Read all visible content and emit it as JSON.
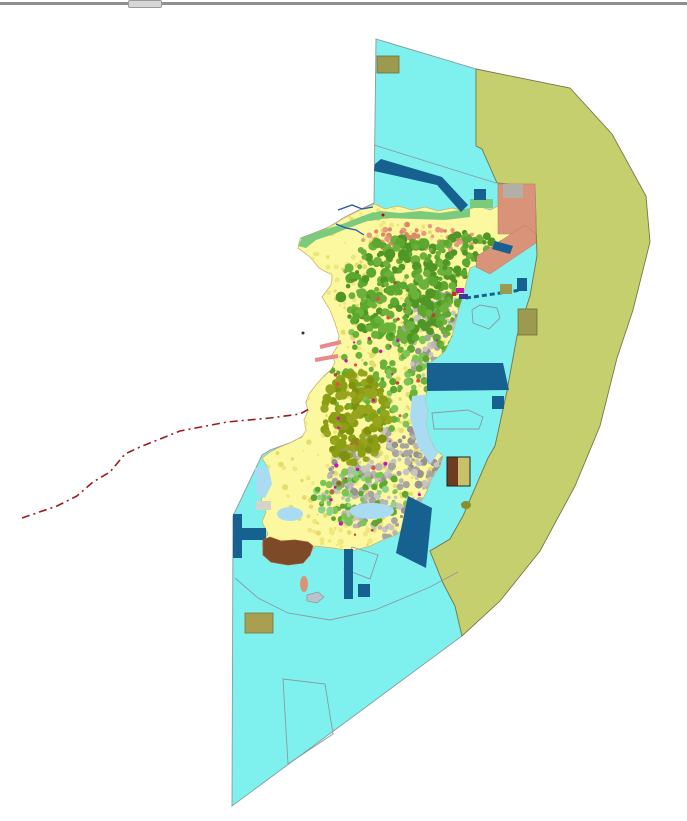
{
  "window": {
    "edge_style": "background:#8f8f8f",
    "handle_style": "background:#d6d6d6;border:1px solid #9a9a9a"
  },
  "map": {
    "width": 687,
    "height": 815,
    "background": "#ffffff",
    "palette": {
      "water": "#7EF1EF",
      "planning_zone": "#C6CF6E",
      "island_base": "#FCF8A0",
      "forest_green": "#5CA82E",
      "olive_parcels": "#8C9E14",
      "urban_gray": "#A8A5A0",
      "reclamation_salmon": "#D99379",
      "harbor_blue": "#16618F",
      "khaki_parcel": "#9C9A4E",
      "boundary_red": "#9E1A1A",
      "coast_green": "#7CCB7C",
      "lagoon_blue": "#A9DCF2",
      "brown_fill": "#7C4A26"
    },
    "island_outline": "375,198 385,203 398,200 412,204 425,201 438,205 452,202 465,205 478,200 490,204 498,200 498,178 535,178 536,228 527,240 510,252 495,260 480,258 470,262 466,278 463,290 459,302 456,315 452,330 445,345 437,352 429,357 427,362 427,385 425,395 428,405 426,418 429,430 435,443 443,450 440,460 432,472 426,487 419,500 412,510 405,520 398,528 385,533 370,540 352,545 333,542 315,540 303,557 280,556 266,551 262,538 268,528 262,516 266,506 261,493 269,482 262,472 268,462 262,452 270,446 280,441 292,436 302,431 306,424 304,414 308,405 306,397 309,388 316,379 323,371 331,364 335,356 332,349 337,341 339,330 335,317 330,304 322,291 331,279 332,269 319,262 310,251 298,242 300,233 313,228 328,222 344,212 360,204",
    "shapes": [
      {
        "name": "water-area",
        "type": "polygon",
        "pts": "376,33 476,63 476,140 482,143 497,177 535,180 537,250 530,290 517,330 507,385 495,440 488,452 463,510 450,533 430,545 443,577 455,600 462,630 232,800 233,510 262,449 270,444 292,436 303,430 307,423 305,414 309,404 306,396 310,387 317,378 324,370 332,363 336,355 333,348 338,340 340,329 336,316 331,303 323,290 332,278 333,268 320,261 311,250 299,241 301,232 314,227 329,221 345,211 361,203 374,197",
        "fill": "#7EF1EF",
        "stroke": "#8A9AA0",
        "sw": 0.9
      },
      {
        "name": "planning-zone",
        "type": "polygon",
        "pts": "476,63 570,82 612,128 646,190 650,236 633,304 617,352 600,420 575,480 540,545 500,595 462,630 455,600 443,577 430,545 450,533 463,510 488,452 495,440 507,385 517,330 530,290 537,250 535,180 497,177 482,143 476,140",
        "fill": "#C6CF6E",
        "stroke": "#77774D",
        "sw": 0.9
      },
      {
        "name": "water-division-line-north",
        "type": "polyline",
        "pts": "374,139 496,177",
        "stroke": "#8A9AA0",
        "sw": 0.9
      },
      {
        "name": "water-division-line-south",
        "type": "polyline",
        "pts": "235,572 258,592 288,607 330,614 375,604 430,581 458,566",
        "stroke": "#8A9AA0",
        "sw": 0.9
      },
      {
        "name": "survey-parcel-outline",
        "type": "polygon",
        "pts": "283,673 325,678 333,728 288,758",
        "fill": "none",
        "stroke": "#8A9AA0",
        "sw": 0.9
      },
      {
        "name": "khaki-parcel-north",
        "type": "rect",
        "x": 377,
        "y": 50,
        "w": 22,
        "h": 17,
        "fill": "#9C9A4E",
        "stroke": "#6F6E35",
        "sw": 0.8
      },
      {
        "name": "island-landmass",
        "type": "polygon",
        "use_outline": true,
        "fill": "#FCF8A0",
        "stroke": "#C9B568",
        "sw": 0.8
      },
      {
        "name": "parcel-texture",
        "type": "speckles",
        "seed": 1,
        "cx": 380,
        "cy": 380,
        "rx": 125,
        "ry": 180,
        "count": 550,
        "rmin": 1,
        "rmax": 3,
        "colors": [
          "#EFE77E",
          "#E6DC6C"
        ],
        "clip": true
      },
      {
        "name": "road-texture-north",
        "type": "speckles",
        "seed": 2,
        "cx": 420,
        "cy": 232,
        "rx": 58,
        "ry": 14,
        "count": 70,
        "rmin": 1.5,
        "rmax": 3,
        "colors": [
          "#E59980",
          "#D98868"
        ],
        "clip": true
      },
      {
        "name": "urban-south",
        "type": "speckles",
        "seed": 3,
        "cx": 402,
        "cy": 478,
        "rx": 80,
        "ry": 55,
        "count": 430,
        "rmin": 1.5,
        "rmax": 4,
        "colors": [
          "#A8A5A0",
          "#B9B6B1",
          "#C8C5C0",
          "#979490"
        ],
        "clip": true
      },
      {
        "name": "urban-east",
        "type": "speckles",
        "seed": 4,
        "cx": 443,
        "cy": 330,
        "rx": 40,
        "ry": 46,
        "count": 190,
        "rmin": 1.5,
        "rmax": 4,
        "colors": [
          "#A8A5A0",
          "#B9B6B1",
          "#C8C5C0",
          "#979490"
        ],
        "clip": true
      },
      {
        "name": "green-mid",
        "type": "speckles",
        "seed": 5,
        "cx": 393,
        "cy": 368,
        "rx": 68,
        "ry": 55,
        "count": 130,
        "rmin": 2,
        "rmax": 4,
        "colors": [
          "#5CA82E",
          "#6BB13A",
          "#7CC455"
        ],
        "clip": true
      },
      {
        "name": "green-hills-north",
        "type": "speckles",
        "seed": 6,
        "cx": 398,
        "cy": 283,
        "rx": 58,
        "ry": 52,
        "count": 260,
        "rmin": 2,
        "rmax": 5.5,
        "colors": [
          "#5CA82E",
          "#6BB13A",
          "#4F9626"
        ],
        "clip": true
      },
      {
        "name": "green-hills-ne",
        "type": "speckles",
        "seed": 7,
        "cx": 472,
        "cy": 252,
        "rx": 36,
        "ry": 26,
        "count": 90,
        "rmin": 2,
        "rmax": 4.5,
        "colors": [
          "#5CA82E",
          "#6BB13A",
          "#4F9626"
        ],
        "clip": true
      },
      {
        "name": "green-hills-east",
        "type": "speckles",
        "seed": 8,
        "cx": 455,
        "cy": 322,
        "rx": 24,
        "ry": 30,
        "count": 60,
        "rmin": 2,
        "rmax": 4.5,
        "colors": [
          "#5CA82E",
          "#6BB13A"
        ],
        "clip": true
      },
      {
        "name": "olive-hill-central",
        "type": "speckles",
        "seed": 9,
        "cx": 356,
        "cy": 412,
        "rx": 33,
        "ry": 47,
        "count": 150,
        "rmin": 2.5,
        "rmax": 5,
        "colors": [
          "#8C9E14",
          "#7F9210",
          "#96A51C"
        ],
        "clip": true
      },
      {
        "name": "green-south",
        "type": "speckles",
        "seed": 10,
        "cx": 360,
        "cy": 492,
        "rx": 48,
        "ry": 28,
        "count": 85,
        "rmin": 2,
        "rmax": 4,
        "colors": [
          "#7CC455",
          "#8FD287",
          "#5CA82E"
        ],
        "clip": true
      },
      {
        "name": "red-roof-bits",
        "type": "speckles",
        "seed": 11,
        "cx": 400,
        "cy": 420,
        "rx": 85,
        "ry": 145,
        "count": 50,
        "rmin": 1,
        "rmax": 2.2,
        "colors": [
          "#C04040",
          "#C812B4",
          "#E05050"
        ],
        "clip": true
      },
      {
        "name": "lagoon-east",
        "type": "polygon",
        "pts": "412,390 430,388 434,415 440,445 430,458 418,440 410,412",
        "fill": "#A9DCF2",
        "clip": true
      },
      {
        "name": "lagoon-south-1",
        "type": "ellipse",
        "cx": 372,
        "cy": 505,
        "rx": 22,
        "ry": 8,
        "fill": "#A9DCF2",
        "clip": true
      },
      {
        "name": "lagoon-south-2",
        "type": "ellipse",
        "cx": 290,
        "cy": 508,
        "rx": 13,
        "ry": 7,
        "fill": "#A9DCF2",
        "clip": true
      },
      {
        "name": "west-inlet",
        "type": "polygon",
        "pts": "255,462 268,460 272,478 265,492 256,488",
        "fill": "#A9DCF2"
      },
      {
        "name": "west-flat-patch",
        "type": "rect",
        "x": 256,
        "y": 495,
        "w": 15,
        "h": 9,
        "fill": "#D6D4CA"
      },
      {
        "name": "coast-strip-nw",
        "type": "polygon",
        "pts": "298,240 302,232 315,227 330,222 345,217 360,211 374,206 377,212 362,217 346,223 331,229 316,234 306,242",
        "fill": "#7CCB7C"
      },
      {
        "name": "coast-strip-north",
        "type": "polygon",
        "pts": "360,211 380,205 400,207 420,205 440,207 460,204 470,202 470,211 445,214 415,213 388,212 370,215",
        "fill": "#7CCB7C"
      },
      {
        "name": "green-parcel-ne",
        "type": "rect",
        "x": 470,
        "y": 193,
        "w": 23,
        "h": 9,
        "fill": "#7CCB7C"
      },
      {
        "name": "reclamation-ne",
        "type": "polygon",
        "pts": "498,178 535,178 536,228 498,228",
        "fill": "#D99379",
        "stroke": "#B97A5E",
        "sw": 0.5
      },
      {
        "name": "reclamation-band",
        "type": "polygon",
        "pts": "477,250 525,219 536,228 536,237 490,268 476,261",
        "fill": "#D99379",
        "stroke": "#B97A5E",
        "sw": 0.5
      },
      {
        "name": "gray-blob-ne",
        "type": "rect",
        "x": 503,
        "y": 178,
        "w": 20,
        "h": 14,
        "fill": "#B3AFA7"
      },
      {
        "name": "breakwater-nw",
        "type": "polygon",
        "pts": "375,158 381,153 442,171 468,199 461,206 437,179 374,165",
        "fill": "#16618F"
      },
      {
        "name": "harbor-rect-n",
        "type": "rect",
        "x": 474,
        "y": 183,
        "w": 12,
        "h": 11,
        "fill": "#16618F"
      },
      {
        "name": "harbor-band-ne",
        "type": "polygon",
        "pts": "495,235 513,240 510,248 492,243",
        "fill": "#16618F"
      },
      {
        "name": "harbor-band-east",
        "type": "polygon",
        "pts": "427,357 503,357 509,384 427,385",
        "fill": "#16618F"
      },
      {
        "name": "harbor-sq-east",
        "type": "rect",
        "x": 492,
        "y": 390,
        "w": 12,
        "h": 13,
        "fill": "#16618F"
      },
      {
        "name": "jetty-dashed",
        "type": "line",
        "x1": 466,
        "y1": 292,
        "x2": 521,
        "y2": 284,
        "stroke": "#16618F",
        "sw": 3,
        "dash": "5 3"
      },
      {
        "name": "terminal-magenta",
        "type": "rect",
        "x": 456,
        "y": 282,
        "w": 8,
        "h": 5,
        "fill": "#C812B4"
      },
      {
        "name": "terminal-blue",
        "type": "rect",
        "x": 459,
        "y": 288,
        "w": 9,
        "h": 5,
        "fill": "#3A3A9E"
      },
      {
        "name": "terminal-red",
        "type": "rect",
        "x": 452,
        "y": 286,
        "w": 4,
        "h": 4,
        "fill": "#D03030"
      },
      {
        "name": "khaki-sq-east",
        "type": "rect",
        "x": 500,
        "y": 278,
        "w": 12,
        "h": 10,
        "fill": "#9C9A4E"
      },
      {
        "name": "blue-sq-east",
        "type": "rect",
        "x": 517,
        "y": 272,
        "w": 10,
        "h": 13,
        "fill": "#16618F"
      },
      {
        "name": "khaki-parcel-east",
        "type": "rect",
        "x": 518,
        "y": 303,
        "w": 19,
        "h": 26,
        "fill": "#9C9A4E",
        "stroke": "#6F6E35",
        "sw": 0.8
      },
      {
        "name": "pentagon-outline-east",
        "type": "polygon",
        "pts": "480,299 497,302 500,312 489,323 473,317 472,304",
        "fill": "none",
        "stroke": "#8A9AA0",
        "sw": 0.9
      },
      {
        "name": "quad-outline-east",
        "type": "polygon",
        "pts": "432,407 468,404 483,411 479,423 434,423",
        "fill": "none",
        "stroke": "#8A9AA0",
        "sw": 0.9
      },
      {
        "name": "diamond-outline-south",
        "type": "polygon",
        "pts": "352,541 378,549 370,573 344,563",
        "fill": "none",
        "stroke": "#8A9AA0",
        "sw": 0.9
      },
      {
        "name": "facility-brown-half",
        "type": "rect",
        "x": 447,
        "y": 451,
        "w": 11,
        "h": 29,
        "fill": "#6E3C1E"
      },
      {
        "name": "facility-khaki-half",
        "type": "rect",
        "x": 458,
        "y": 451,
        "w": 12,
        "h": 29,
        "fill": "#C9C06A"
      },
      {
        "name": "facility-outline",
        "type": "rect",
        "x": 447,
        "y": 451,
        "w": 23,
        "h": 29,
        "fill": "none",
        "stroke": "#222222",
        "sw": 1
      },
      {
        "name": "olive-islet",
        "type": "ellipse",
        "cx": 466,
        "cy": 499,
        "rx": 5,
        "ry": 4,
        "fill": "#8C8C2A"
      },
      {
        "name": "harbor-band-se",
        "type": "polygon",
        "pts": "408,490 432,502 426,562 396,547",
        "fill": "#16618F"
      },
      {
        "name": "pier-strip-south",
        "type": "rect",
        "x": 344,
        "y": 543,
        "w": 9,
        "h": 50,
        "fill": "#16618F"
      },
      {
        "name": "pier-sq-south",
        "type": "rect",
        "x": 358,
        "y": 578,
        "w": 12,
        "h": 13,
        "fill": "#16618F"
      },
      {
        "name": "t-pier-vertical",
        "type": "rect",
        "x": 233,
        "y": 508,
        "w": 9,
        "h": 44,
        "fill": "#16618F"
      },
      {
        "name": "t-pier-horizontal",
        "type": "rect",
        "x": 242,
        "y": 522,
        "w": 24,
        "h": 12,
        "fill": "#16618F"
      },
      {
        "name": "brown-hill-sw",
        "type": "polygon",
        "pts": "263,534 270,531 281,535 295,534 308,536 313,540 310,549 303,557 288,559 271,556 263,549",
        "fill": "#7C4A26",
        "stroke": "#B05030",
        "sw": 0.8
      },
      {
        "name": "salmon-islet",
        "type": "ellipse",
        "cx": 304,
        "cy": 578,
        "rx": 4,
        "ry": 8,
        "fill": "#D99379"
      },
      {
        "name": "gray-islet",
        "type": "polygon",
        "pts": "307,589 318,586 324,591 317,597 307,595",
        "fill": "#B9C3CA",
        "stroke": "#88969E",
        "sw": 0.7
      },
      {
        "name": "khaki-parcel-south",
        "type": "rect",
        "x": 245,
        "y": 607,
        "w": 28,
        "h": 20,
        "fill": "#A8A050",
        "stroke": "#77743C",
        "sw": 0.8
      },
      {
        "name": "stream-nw-1",
        "type": "polyline",
        "pts": "338,204 352,199 362,203 373,201",
        "stroke": "#2255BB",
        "sw": 1.3
      },
      {
        "name": "stream-nw-2",
        "type": "polyline",
        "pts": "336,218 346,222 356,224 364,229",
        "stroke": "#2255BB",
        "sw": 1.3
      },
      {
        "name": "road-stub-west-1",
        "type": "line",
        "x1": 320,
        "y1": 341,
        "x2": 341,
        "y2": 336,
        "stroke": "#E88A8A",
        "sw": 4
      },
      {
        "name": "road-stub-west-2",
        "type": "line",
        "x1": 315,
        "y1": 354,
        "x2": 338,
        "y2": 350,
        "stroke": "#E88A8A",
        "sw": 4
      },
      {
        "name": "boundary-line-red",
        "type": "polyline",
        "pts": "22,512 57,500 77,490 93,476 110,466 125,448 140,441 180,425 227,416 270,412 300,408 309,403",
        "stroke": "#9E1A1A",
        "sw": 1.6,
        "dash": "8 4 2 4"
      },
      {
        "name": "red-marker-dot",
        "type": "circle",
        "cx": 383,
        "cy": 209,
        "r": 1.5,
        "fill": "#CC0000"
      },
      {
        "name": "dark-marker-dot",
        "type": "circle",
        "cx": 303,
        "cy": 327,
        "r": 1.5,
        "fill": "#333333"
      }
    ]
  }
}
